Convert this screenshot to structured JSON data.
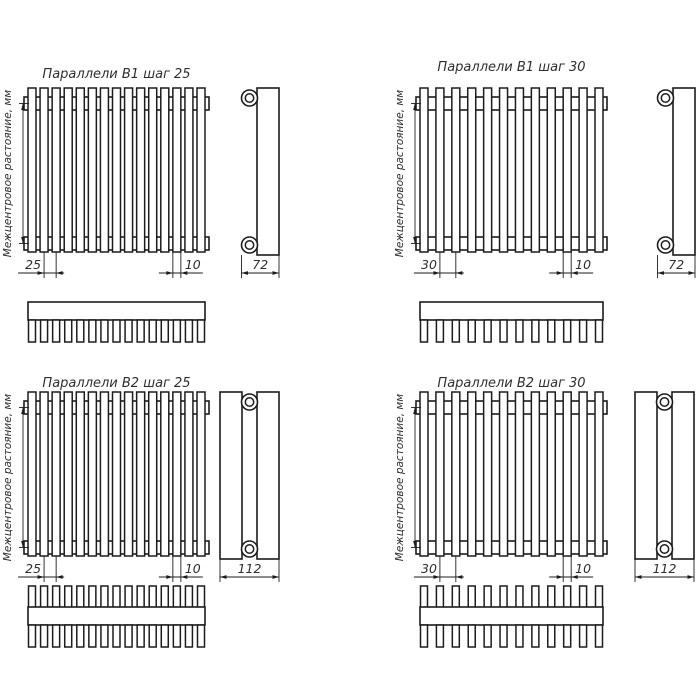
{
  "drawing": {
    "background": "#ffffff",
    "line_color": "#1c1c1c",
    "text_color": "#2e2e2e",
    "vertical_axis_label": "Межцентровое растояние, мм"
  },
  "diagrams": [
    {
      "title": "Параллели В1 шаг 25",
      "step": "25",
      "tube_width": "10",
      "depth": "72",
      "tubes": 15,
      "rows": 1
    },
    {
      "title": "Параллели В1 шаг 30",
      "step": "30",
      "tube_width": "10",
      "depth": "72",
      "tubes": 12,
      "rows": 1
    },
    {
      "title": "Параллели В2 шаг 25",
      "step": "25",
      "tube_width": "10",
      "depth": "112",
      "tubes": 15,
      "rows": 2
    },
    {
      "title": "Параллели В2 шаг 30",
      "step": "30",
      "tube_width": "10",
      "depth": "112",
      "tubes": 12,
      "rows": 2
    }
  ]
}
